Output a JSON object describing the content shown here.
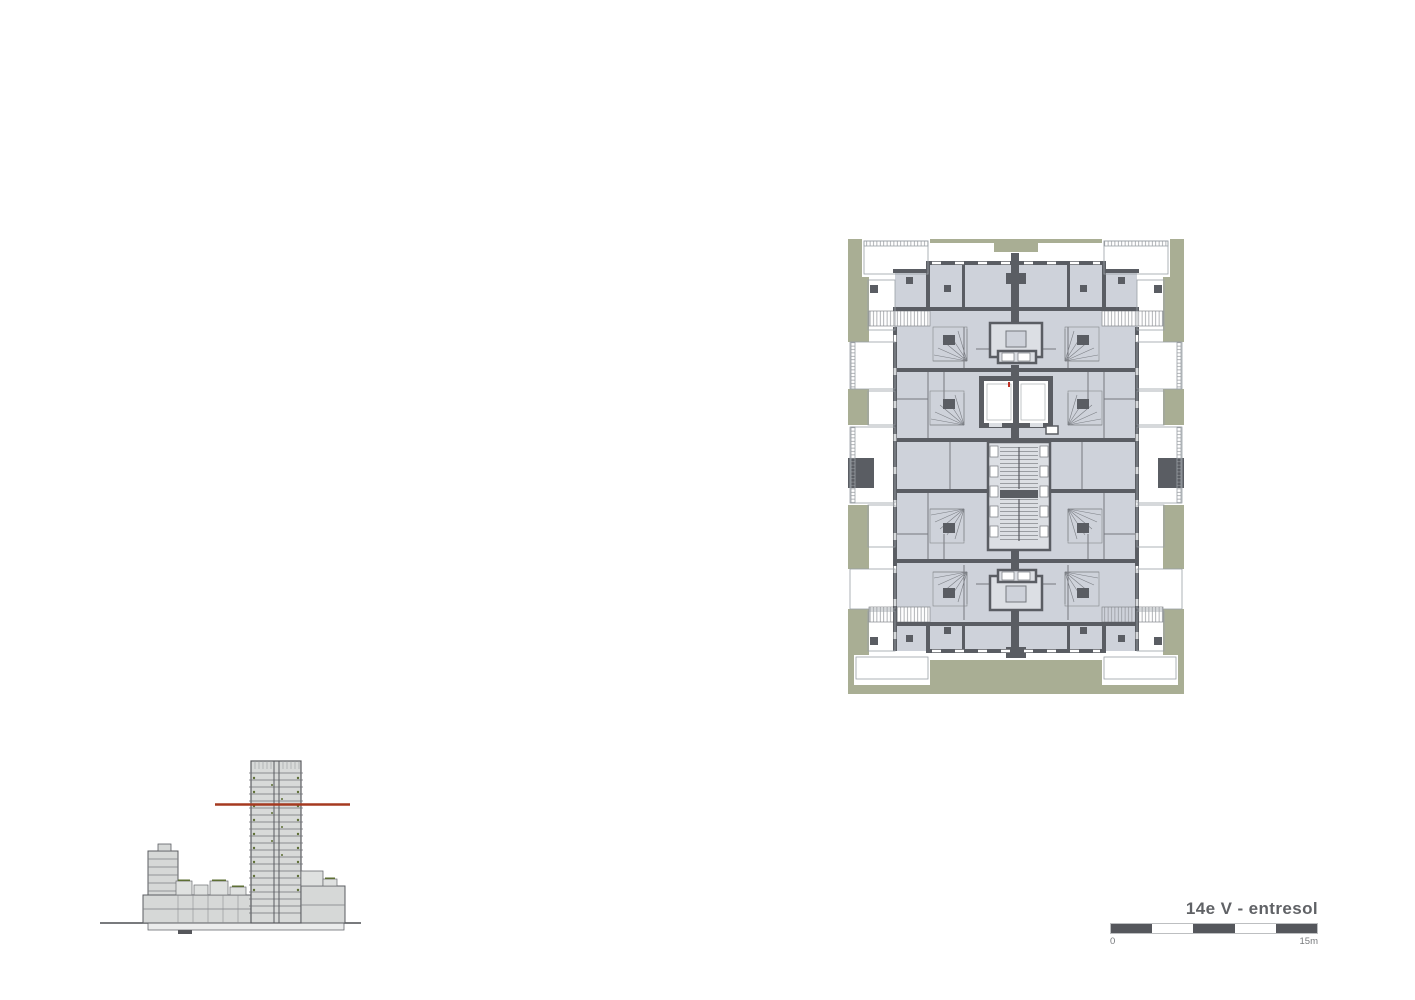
{
  "title_block": {
    "title": "14e V - entresol",
    "scale": {
      "start_label": "0",
      "end_label": "15m",
      "segments": 5
    }
  },
  "floor_plan": {
    "colors": {
      "site_green": "#a9ae94",
      "room_fill": "#ced2da",
      "wall": "#5a5d63",
      "core_fill": "#dcdfe4",
      "elevator_marker_red": "#c03126"
    }
  },
  "section": {
    "cut_line_color": "#a53a20"
  }
}
